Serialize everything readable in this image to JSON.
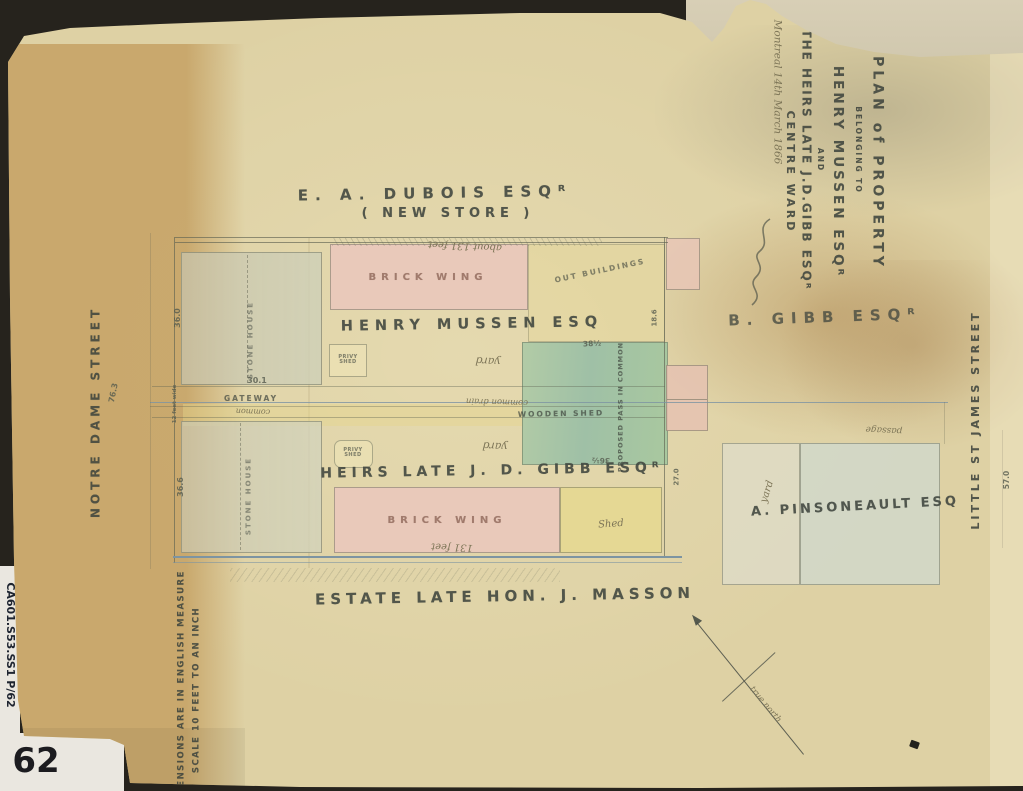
{
  "colors": {
    "bg": "#26231d",
    "paper": "#ded1a4",
    "fold": "#c5a163",
    "backing": "#d4cbb0",
    "patch": "#eae7e0",
    "ink": "#3f453e",
    "faded": "#7d7557",
    "red-ink": "#8a6052",
    "blue-line": "#7d94a2",
    "pink": "#e9c9ba",
    "green": "#abc7a2",
    "yellow": "#e6d78f"
  },
  "archive": {
    "sheet_number": "62",
    "call_number": "CA601.S53.SS1 P/62"
  },
  "title_block": {
    "line1": "PLAN of PROPERTY",
    "line2": "BELONGING TO",
    "line3": "HENRY MUSSEN ESQᴿ",
    "line4": "AND",
    "line5": "THE HEIRS LATE J.D.GIBB ESQᴿ",
    "line6": "CENTRE WARD",
    "dateline": "Montreal 14th March 1866"
  },
  "streets": {
    "west": "NOTRE DAME STREET",
    "east": "LITTLE ST JAMES STREET"
  },
  "neighbours": {
    "north": "E. A. DUBOIS ESQᴿ",
    "north_note": "( NEW STORE )",
    "east": "B. GIBB ESQᴿ",
    "southeast": "A. PINSONEAULT ESQ",
    "south": "ESTATE LATE HON. J. MASSON"
  },
  "owners": {
    "upper": "HENRY MUSSEN ESQ",
    "lower": "HEIRS LATE J. D. GIBB ESQᴿ"
  },
  "features": {
    "brick_wing": "BRICK WING",
    "wooden_shed": "WOODEN SHED",
    "shed": "Shed",
    "stone_house": "STONE HOUSE",
    "privy_line1": "PRIVY",
    "privy_line2": "SHED",
    "gateway": "GATEWAY",
    "gateway_note": "common",
    "drain": "common drain",
    "proposed_pass": "PROPOSED PASS IN COMMON",
    "out_buildings": "OUT BUILDINGS",
    "passage": "passage",
    "yard": "yard"
  },
  "dimensions": {
    "top_width": "about 131 feet",
    "bottom_width": "131 feet",
    "upper_left_width": "36.0",
    "upper_left_base": "30.1",
    "lower_left_width": "36.6",
    "street_frontage": "76.3",
    "gateway_width": "12 feet wide",
    "green_top": "38½",
    "green_bottom": "36½",
    "east_upper": "18.6",
    "east_lower": "27.0",
    "east_block": "57.0"
  },
  "scale_note": {
    "line1": "SCALE 10 FEET TO AN INCH",
    "line2": "DIMENSIONS ARE IN ENGLISH MEASURE"
  },
  "compass": {
    "label": "true north"
  }
}
